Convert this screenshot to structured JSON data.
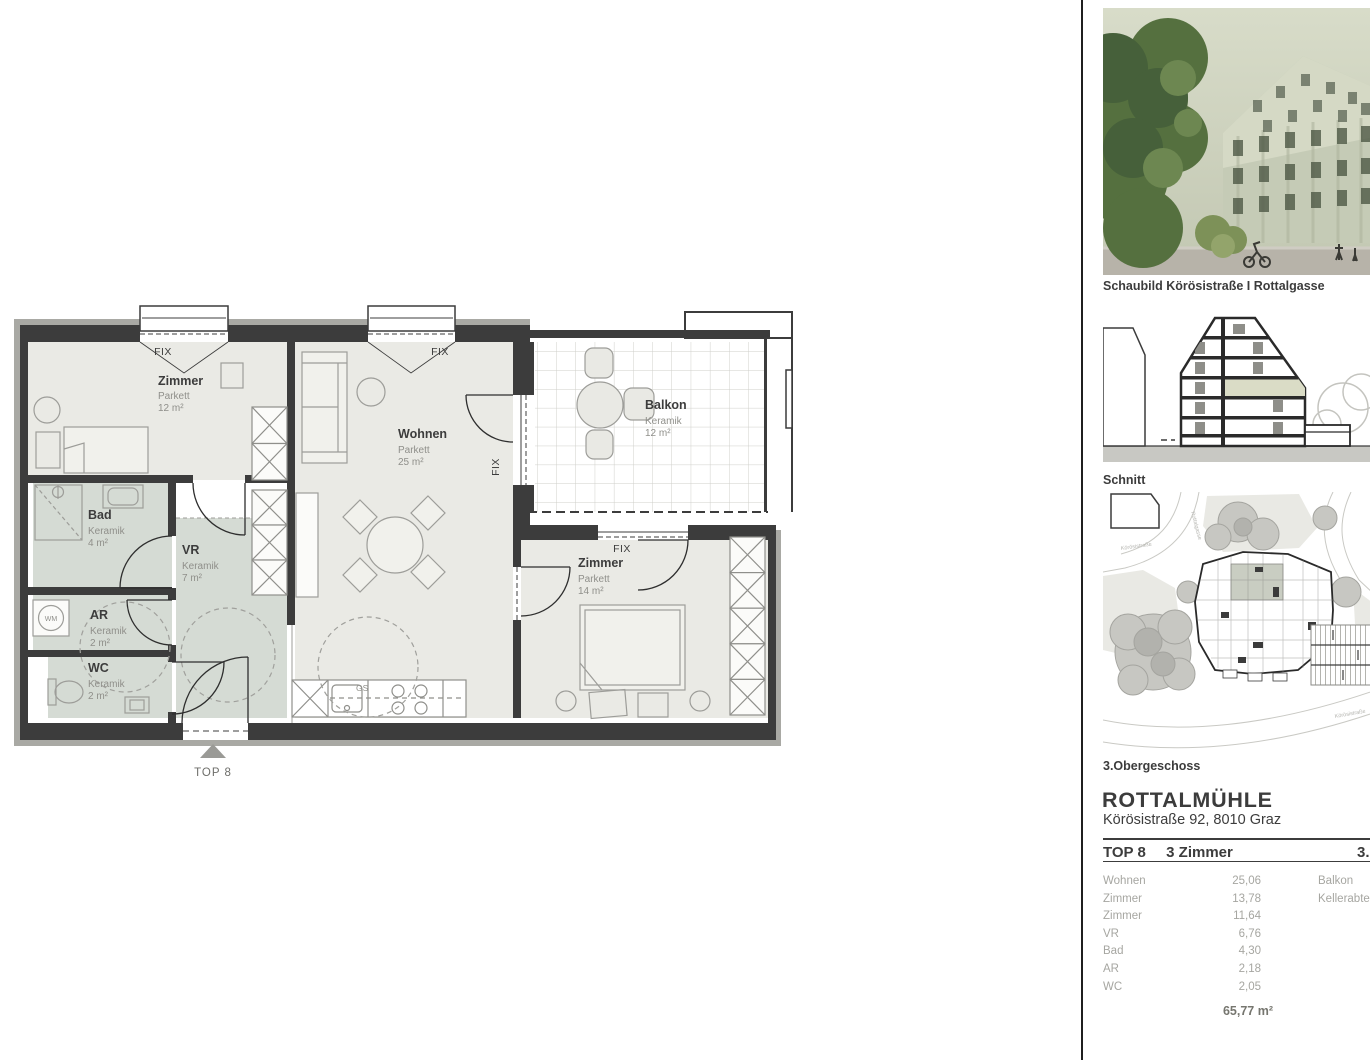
{
  "floorplan": {
    "unit_marker": "TOP 8",
    "window_label": "FIX",
    "dishwasher_label": "GS",
    "washer_label": "WM",
    "rooms": {
      "zimmer1": {
        "name": "Zimmer",
        "finish": "Parkett",
        "area": "12 m²"
      },
      "wohnen": {
        "name": "Wohnen",
        "finish": "Parkett",
        "area": "25 m²"
      },
      "balkon": {
        "name": "Balkon",
        "finish": "Keramik",
        "area": "12 m²"
      },
      "bad": {
        "name": "Bad",
        "finish": "Keramik",
        "area": "4 m²"
      },
      "vr": {
        "name": "VR",
        "finish": "Keramik",
        "area": "7 m²"
      },
      "ar": {
        "name": "AR",
        "finish": "Keramik",
        "area": "2 m²"
      },
      "wc": {
        "name": "WC",
        "finish": "Keramik",
        "area": "2 m²"
      },
      "zimmer2": {
        "name": "Zimmer",
        "finish": "Parkett",
        "area": "14 m²"
      }
    }
  },
  "sidebar": {
    "render_caption": "Schaubild Körösistraße I Rottalgasse",
    "section_caption": "Schnitt",
    "siteplan_caption": "3.Obergeschoss",
    "siteplan_street_labels": [
      "Rottalgasse",
      "Körösistraße",
      "Körösistraße"
    ],
    "project_title": "ROTTALMÜHLE",
    "project_address": "Körösistraße 92, 8010 Graz",
    "unit": {
      "id": "TOP 8",
      "type": "3 Zimmer",
      "floor": "3.OG"
    },
    "area_table": [
      {
        "label": "Wohnen",
        "value": "25,06"
      },
      {
        "label": "Zimmer",
        "value": "13,78"
      },
      {
        "label": "Zimmer",
        "value": "11,64"
      },
      {
        "label": "VR",
        "value": "6,76"
      },
      {
        "label": "Bad",
        "value": "4,30"
      },
      {
        "label": "AR",
        "value": "2,18"
      },
      {
        "label": "WC",
        "value": "2,05"
      }
    ],
    "extra_table": [
      {
        "label": "Balkon"
      },
      {
        "label": "Kellerabteil"
      }
    ],
    "total_area": "65,77 m²"
  },
  "colors": {
    "wall": "#3c3c3c",
    "parquet_room": "#eaeae5",
    "ceramic_room": "#d5dbd4",
    "text_dark": "#3c3c3c",
    "text_muted": "#a6a6a1"
  }
}
